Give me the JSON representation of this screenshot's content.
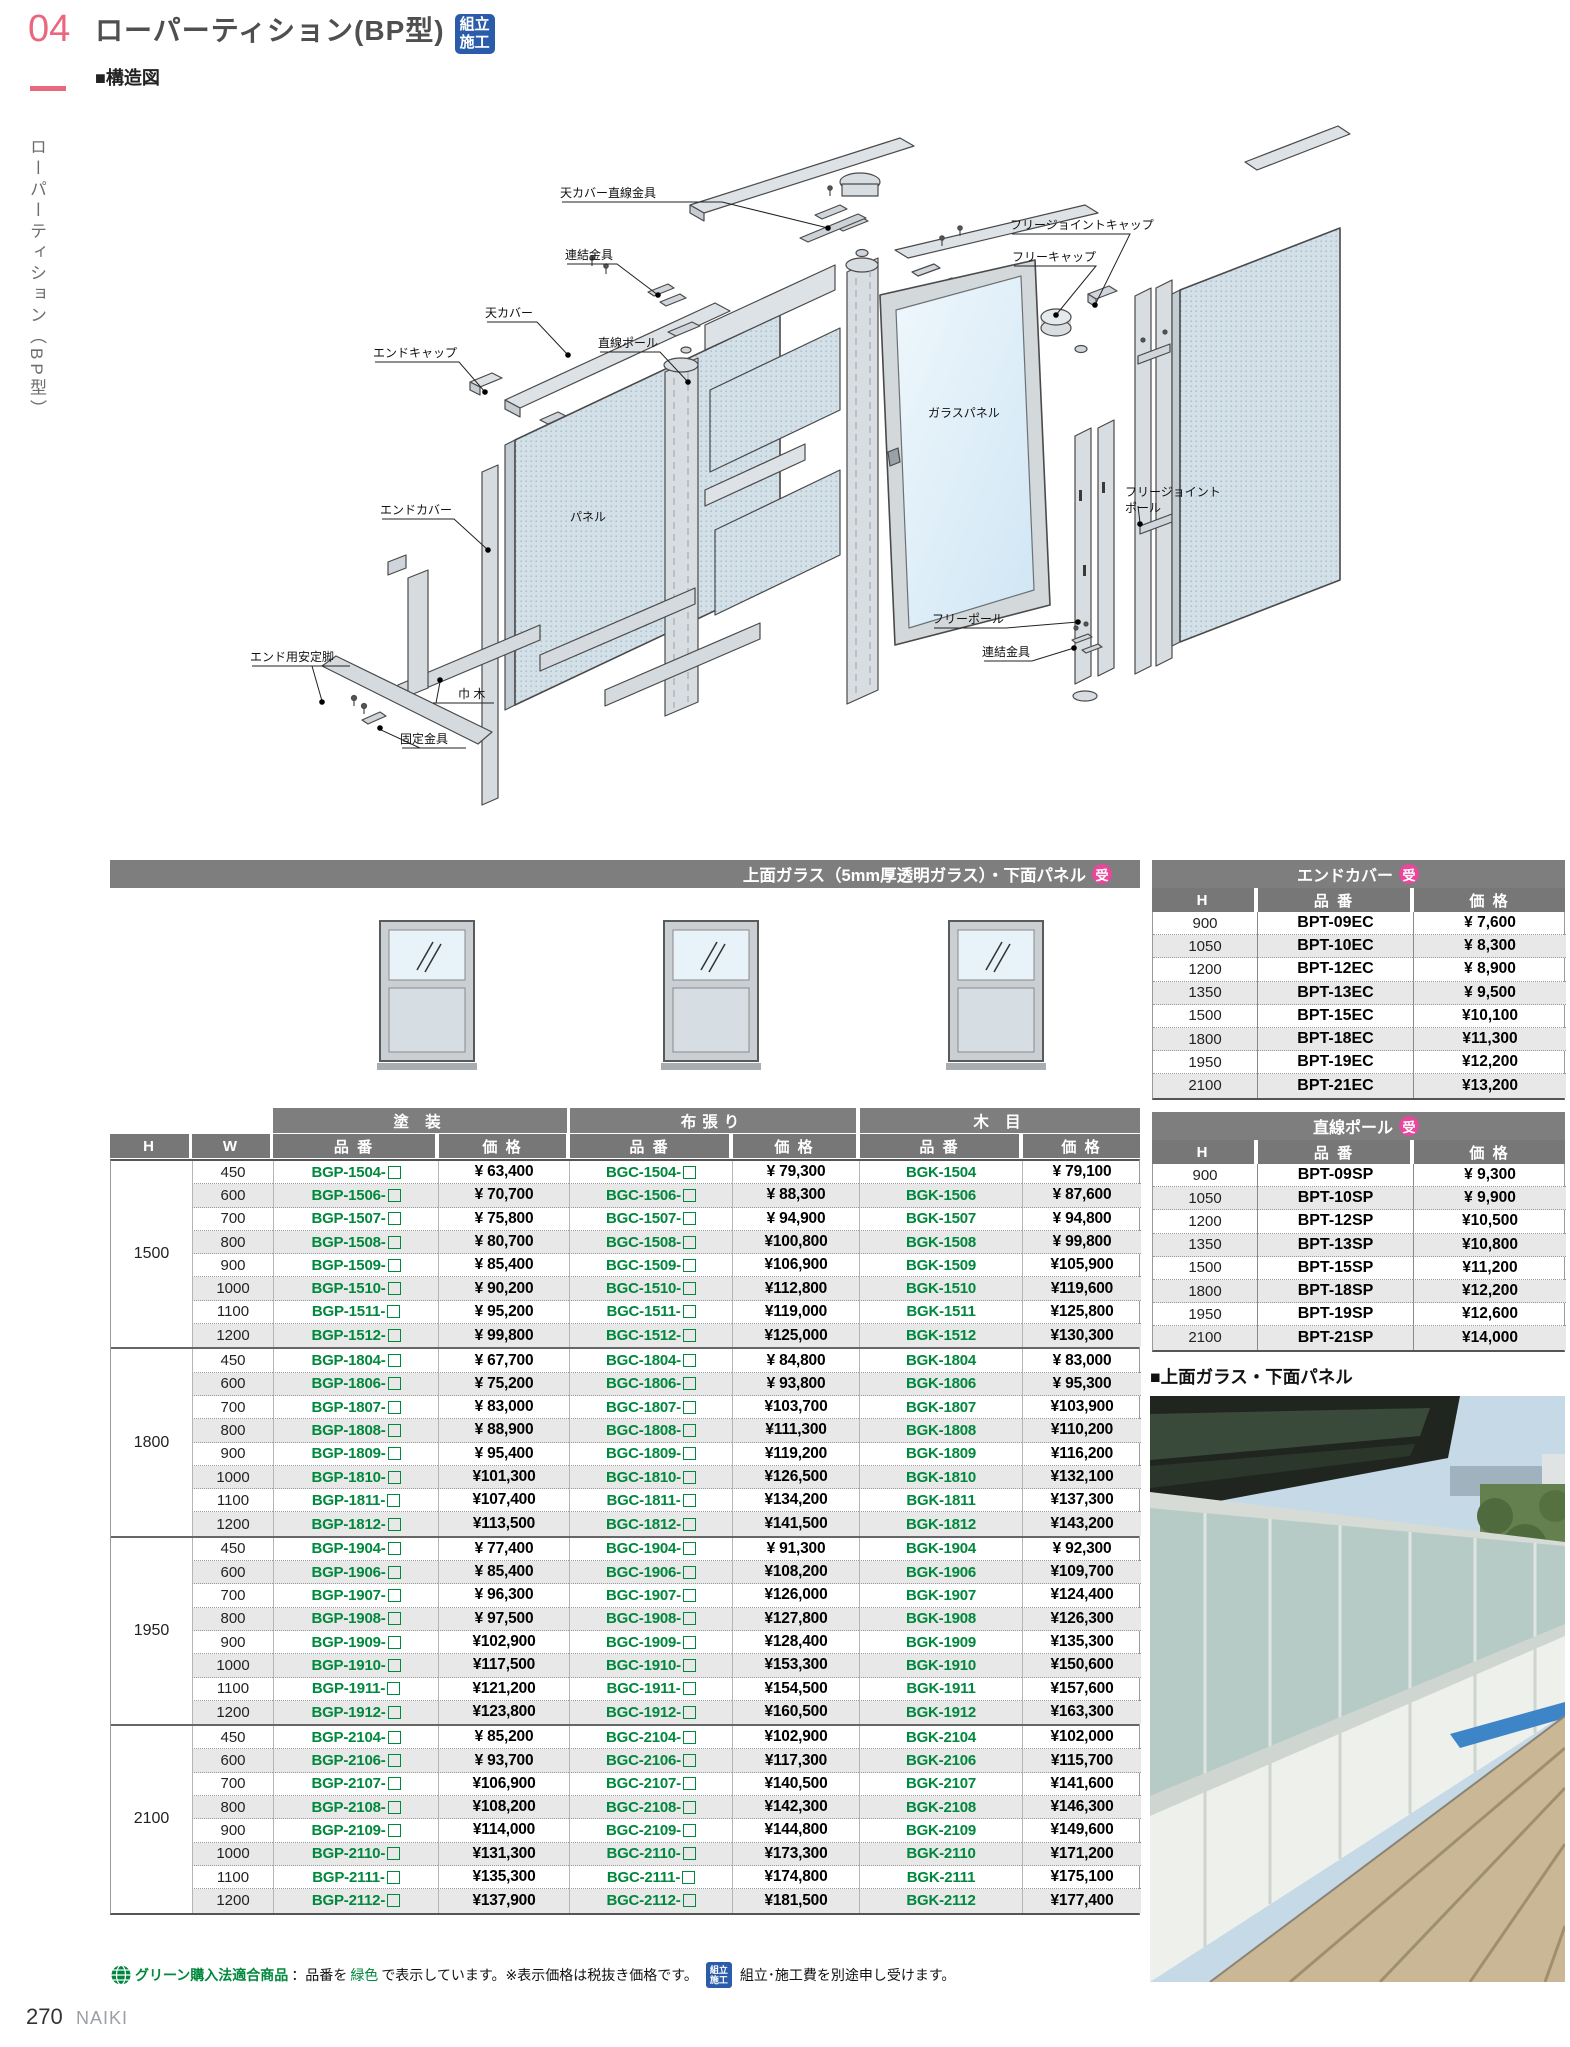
{
  "page": {
    "number": "04",
    "side_label": "ローパーティション（BP型）",
    "title": "ローパーティション(BP型)",
    "structure_heading": "■構造図",
    "assembly_badge": {
      "line1": "組立",
      "line2": "施工"
    },
    "footer_number": "270",
    "footer_brand": "NAIKI"
  },
  "colors": {
    "accent_pink": "#e8687e",
    "order_badge_pink": "#e8479b",
    "product_code_green": "#00883c",
    "assembly_badge_blue": "#2a5caa",
    "table_bar_gray": "#7e7e7e"
  },
  "diagram": {
    "labels": [
      "天カバー直線金具",
      "フリージョイントキャップ",
      "連結金具",
      "フリーキャップ",
      "天カバー",
      "直線ポール",
      "エンドキャップ",
      "ガラスパネル",
      "パネル",
      "エンドカバー",
      "フリージョイントポール",
      "フリーポール",
      "連結金具",
      "エンド用安定脚",
      "巾 木",
      "固定金具"
    ]
  },
  "main_table": {
    "title": "上面ガラス（5mm厚透明ガラス）・下面パネル",
    "order_badge": "受",
    "finish_headers": [
      "塗 装",
      "布張り",
      "木 目"
    ],
    "col_h": "H",
    "col_w": "W",
    "col_code": "品 番",
    "col_price": "価 格",
    "sections": [
      {
        "h": "1500",
        "rows": [
          [
            "450",
            "BGP-1504-",
            "¥ 63,400",
            "BGC-1504-",
            "¥ 79,300",
            "BGK-1504",
            "¥ 79,100"
          ],
          [
            "600",
            "BGP-1506-",
            "¥ 70,700",
            "BGC-1506-",
            "¥ 88,300",
            "BGK-1506",
            "¥ 87,600"
          ],
          [
            "700",
            "BGP-1507-",
            "¥ 75,800",
            "BGC-1507-",
            "¥ 94,900",
            "BGK-1507",
            "¥ 94,800"
          ],
          [
            "800",
            "BGP-1508-",
            "¥ 80,700",
            "BGC-1508-",
            "¥100,800",
            "BGK-1508",
            "¥ 99,800"
          ],
          [
            "900",
            "BGP-1509-",
            "¥ 85,400",
            "BGC-1509-",
            "¥106,900",
            "BGK-1509",
            "¥105,900"
          ],
          [
            "1000",
            "BGP-1510-",
            "¥ 90,200",
            "BGC-1510-",
            "¥112,800",
            "BGK-1510",
            "¥119,600"
          ],
          [
            "1100",
            "BGP-1511-",
            "¥ 95,200",
            "BGC-1511-",
            "¥119,000",
            "BGK-1511",
            "¥125,800"
          ],
          [
            "1200",
            "BGP-1512-",
            "¥ 99,800",
            "BGC-1512-",
            "¥125,000",
            "BGK-1512",
            "¥130,300"
          ]
        ]
      },
      {
        "h": "1800",
        "rows": [
          [
            "450",
            "BGP-1804-",
            "¥ 67,700",
            "BGC-1804-",
            "¥ 84,800",
            "BGK-1804",
            "¥ 83,000"
          ],
          [
            "600",
            "BGP-1806-",
            "¥ 75,200",
            "BGC-1806-",
            "¥ 93,800",
            "BGK-1806",
            "¥ 95,300"
          ],
          [
            "700",
            "BGP-1807-",
            "¥ 83,000",
            "BGC-1807-",
            "¥103,700",
            "BGK-1807",
            "¥103,900"
          ],
          [
            "800",
            "BGP-1808-",
            "¥ 88,900",
            "BGC-1808-",
            "¥111,300",
            "BGK-1808",
            "¥110,200"
          ],
          [
            "900",
            "BGP-1809-",
            "¥ 95,400",
            "BGC-1809-",
            "¥119,200",
            "BGK-1809",
            "¥116,200"
          ],
          [
            "1000",
            "BGP-1810-",
            "¥101,300",
            "BGC-1810-",
            "¥126,500",
            "BGK-1810",
            "¥132,100"
          ],
          [
            "1100",
            "BGP-1811-",
            "¥107,400",
            "BGC-1811-",
            "¥134,200",
            "BGK-1811",
            "¥137,300"
          ],
          [
            "1200",
            "BGP-1812-",
            "¥113,500",
            "BGC-1812-",
            "¥141,500",
            "BGK-1812",
            "¥143,200"
          ]
        ]
      },
      {
        "h": "1950",
        "rows": [
          [
            "450",
            "BGP-1904-",
            "¥ 77,400",
            "BGC-1904-",
            "¥ 91,300",
            "BGK-1904",
            "¥ 92,300"
          ],
          [
            "600",
            "BGP-1906-",
            "¥ 85,400",
            "BGC-1906-",
            "¥108,200",
            "BGK-1906",
            "¥109,700"
          ],
          [
            "700",
            "BGP-1907-",
            "¥ 96,300",
            "BGC-1907-",
            "¥126,000",
            "BGK-1907",
            "¥124,400"
          ],
          [
            "800",
            "BGP-1908-",
            "¥ 97,500",
            "BGC-1908-",
            "¥127,800",
            "BGK-1908",
            "¥126,300"
          ],
          [
            "900",
            "BGP-1909-",
            "¥102,900",
            "BGC-1909-",
            "¥128,400",
            "BGK-1909",
            "¥135,300"
          ],
          [
            "1000",
            "BGP-1910-",
            "¥117,500",
            "BGC-1910-",
            "¥153,300",
            "BGK-1910",
            "¥150,600"
          ],
          [
            "1100",
            "BGP-1911-",
            "¥121,200",
            "BGC-1911-",
            "¥154,500",
            "BGK-1911",
            "¥157,600"
          ],
          [
            "1200",
            "BGP-1912-",
            "¥123,800",
            "BGC-1912-",
            "¥160,500",
            "BGK-1912",
            "¥163,300"
          ]
        ]
      },
      {
        "h": "2100",
        "rows": [
          [
            "450",
            "BGP-2104-",
            "¥ 85,200",
            "BGC-2104-",
            "¥102,900",
            "BGK-2104",
            "¥102,000"
          ],
          [
            "600",
            "BGP-2106-",
            "¥ 93,700",
            "BGC-2106-",
            "¥117,300",
            "BGK-2106",
            "¥115,700"
          ],
          [
            "700",
            "BGP-2107-",
            "¥106,900",
            "BGC-2107-",
            "¥140,500",
            "BGK-2107",
            "¥141,600"
          ],
          [
            "800",
            "BGP-2108-",
            "¥108,200",
            "BGC-2108-",
            "¥142,300",
            "BGK-2108",
            "¥146,300"
          ],
          [
            "900",
            "BGP-2109-",
            "¥114,000",
            "BGC-2109-",
            "¥144,800",
            "BGK-2109",
            "¥149,600"
          ],
          [
            "1000",
            "BGP-2110-",
            "¥131,300",
            "BGC-2110-",
            "¥173,300",
            "BGK-2110",
            "¥171,200"
          ],
          [
            "1100",
            "BGP-2111-",
            "¥135,300",
            "BGC-2111-",
            "¥174,800",
            "BGK-2111",
            "¥175,100"
          ],
          [
            "1200",
            "BGP-2112-",
            "¥137,900",
            "BGC-2112-",
            "¥181,500",
            "BGK-2112",
            "¥177,400"
          ]
        ]
      }
    ]
  },
  "end_cover_table": {
    "title": "エンドカバー",
    "order_badge": "受",
    "col_h": "H",
    "col_code": "品 番",
    "col_price": "価 格",
    "rows": [
      [
        "900",
        "BPT-09EC",
        "¥ 7,600"
      ],
      [
        "1050",
        "BPT-10EC",
        "¥ 8,300"
      ],
      [
        "1200",
        "BPT-12EC",
        "¥ 8,900"
      ],
      [
        "1350",
        "BPT-13EC",
        "¥ 9,500"
      ],
      [
        "1500",
        "BPT-15EC",
        "¥10,100"
      ],
      [
        "1800",
        "BPT-18EC",
        "¥11,300"
      ],
      [
        "1950",
        "BPT-19EC",
        "¥12,200"
      ],
      [
        "2100",
        "BPT-21EC",
        "¥13,200"
      ]
    ]
  },
  "pole_table": {
    "title": "直線ポール",
    "order_badge": "受",
    "col_h": "H",
    "col_code": "品 番",
    "col_price": "価 格",
    "rows": [
      [
        "900",
        "BPT-09SP",
        "¥ 9,300"
      ],
      [
        "1050",
        "BPT-10SP",
        "¥ 9,900"
      ],
      [
        "1200",
        "BPT-12SP",
        "¥10,500"
      ],
      [
        "1350",
        "BPT-13SP",
        "¥10,800"
      ],
      [
        "1500",
        "BPT-15SP",
        "¥11,200"
      ],
      [
        "1800",
        "BPT-18SP",
        "¥12,200"
      ],
      [
        "1950",
        "BPT-19SP",
        "¥12,600"
      ],
      [
        "2100",
        "BPT-21SP",
        "¥14,000"
      ]
    ]
  },
  "photo": {
    "heading": "■上面ガラス・下面パネル"
  },
  "notes": {
    "green_label": "グリーン購入法適合商品",
    "sep": "：品番を",
    "green_word": "緑色",
    "text_after": "で表示しています。※表示価格は税抜き価格です。",
    "assembly_note": "組立･施工費を別途申し受けます。"
  }
}
